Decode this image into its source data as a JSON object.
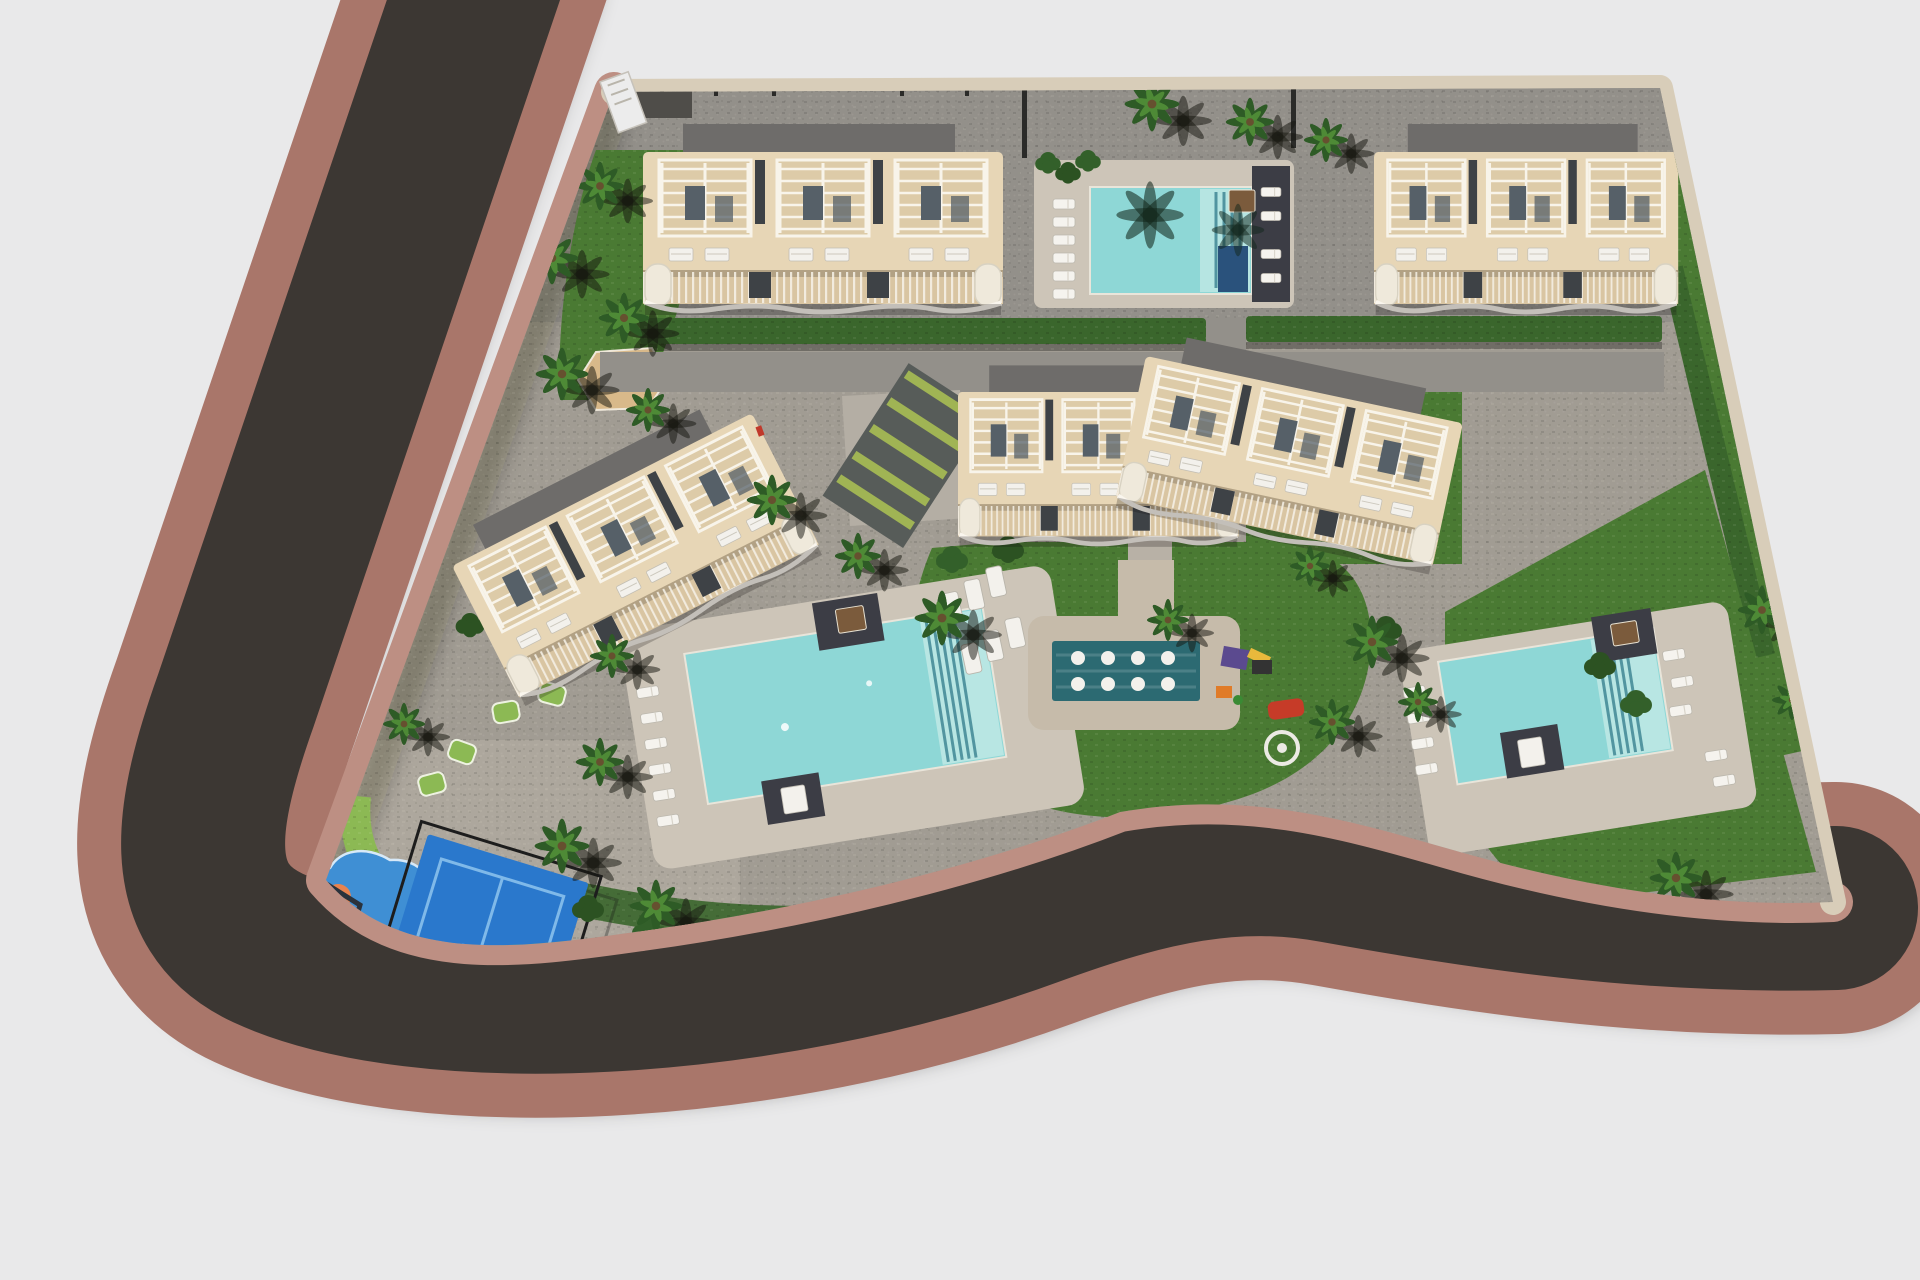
{
  "scene": {
    "type": "aerial-3d-site-plan-render",
    "subject": "residential resort complex with townhouse blocks, pools and gardens",
    "orientation": "top-down bird's eye view, perimeter road wrapping left and bottom edges"
  },
  "palette": {
    "background": "#e9e9ea",
    "road_asphalt": "#3c3733",
    "road_sidewalk": "#a9766a",
    "curb_pink": "#bd8f83",
    "edge_beige": "#d8cdb9",
    "paving": "#a19c93",
    "paving_dark": "#93908a",
    "paving_light": "#b8b1a6",
    "deck": "#cdc5b8",
    "pad_tan": "#c6bbaa",
    "lawn": "#4a7a33",
    "lawn_light": "#8cb954",
    "hedge": "#3a662c",
    "palm_dark": "#2e5b26",
    "palm_light": "#4e8a36",
    "pool_water": "#8ed7d6",
    "pool_water_light": "#c0e9e5",
    "pool_steps": "#3f8694",
    "pool_navy": "#2a527c",
    "spa_water": "#2c6a72",
    "platform_dark": "#3c3d45",
    "bed_brown": "#7b5b3c",
    "building_wall": "#e7d6b6",
    "building_terrace": "#d9c5a2",
    "pergola_bg": "#ddcba8",
    "pergola_white": "#f8f4ea",
    "glass_dark": "#566068",
    "roof_slab": "#6e6c6a",
    "divider_dark": "#3e4246",
    "court_blue": "#2a78cc",
    "court_line": "#7fb9e9",
    "court_fence": "#1d1d1d",
    "splash_blue": "#3f8fd4",
    "splash_orange": "#e8834f",
    "play_red": "#c63b28",
    "play_yellow": "#e8b93c",
    "play_purple": "#5b4a8f",
    "sand": "#d8b98a",
    "white": "#f3f1ec"
  },
  "inventory": {
    "apartment_blocks": 5,
    "swimming_pools": 3,
    "hydromassage_spa_loungers": 8,
    "padel_court": 1,
    "splash_playground": 1,
    "kids_playground": 1,
    "palm_trees": 30
  }
}
